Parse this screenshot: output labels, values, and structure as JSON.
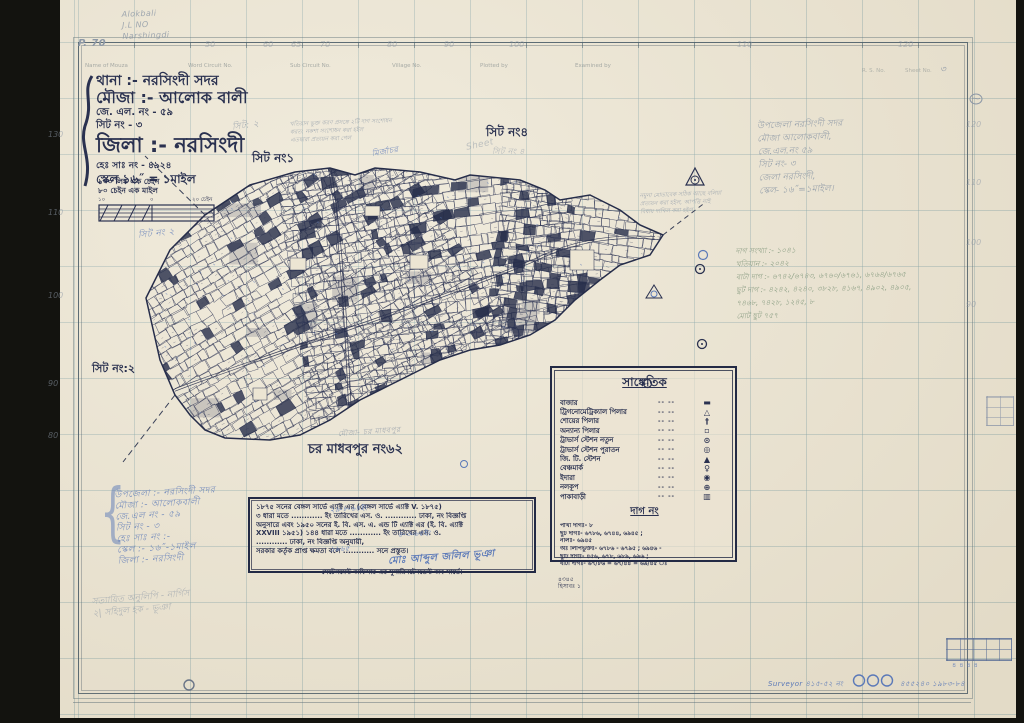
{
  "colors": {
    "ink": "#2a3150",
    "pencil": "#8d98a6",
    "blue": "#5b79b8",
    "paper": "#ece5d3"
  },
  "corner_notes": {
    "p_no": "P. 70",
    "lines": [
      "Alokbali",
      "J.L NO",
      "Narshingdi"
    ]
  },
  "margins": {
    "top_numbers": [
      "50",
      "60",
      "65",
      "70",
      "80",
      "90",
      "100",
      "110",
      "120"
    ],
    "left_numbers": [
      "130",
      "110",
      "100",
      "90",
      "80"
    ],
    "right_numbers": [
      "120",
      "110",
      "100",
      "90"
    ],
    "header_cells": [
      "Name of Mouza",
      "Word Circuit No.",
      "Sub Circuit No.",
      "Village No.",
      "Plotted by",
      "Examined by"
    ],
    "rs_label": "R. S. No.",
    "sheet_label": "Sheet No.",
    "sheet_value": "৩"
  },
  "title_block": {
    "lines": [
      "থানা :- নরসিংদী সদর",
      "মৌজা :- আলোক বালী",
      "জে. এল. নং - ৫৯",
      "সিট নং -  ৩",
      "জিলা :- নরসিংদী",
      "হেঃ সাঃ নং - ৪৯২৪",
      "স্কেল ১৬˝ = ১মাইল"
    ]
  },
  "scale_block": {
    "line1": "১০০ লিঙ্ক এক চেইন",
    "line2": "৮০ চেইন এক মাইল",
    "ticks": [
      "১০",
      "০",
      "২০ চেইন"
    ]
  },
  "sheet_labels": {
    "pencil2": "সিট নং ২",
    "pencil2b": "সিট: ২",
    "ink1": "সিট নং১",
    "ink4": "সিট নং৪",
    "pencil4": "সিট নং ৪",
    "pencil4_en": "Sheet",
    "left2": "সিট নং:২",
    "blue_scrib": "মির্জাচর"
  },
  "map_labels": {
    "south": "চর মাধবপুর নং৬২",
    "south_pencil": "মৌজা- চর মাধবপুর"
  },
  "legend": {
    "title": "সাঙ্কেতিক",
    "dash": "--  --",
    "rows": [
      {
        "label": "বাজার",
        "glyph": "▬"
      },
      {
        "label": "ট্রিগনোমেট্রিক্যাল পিলার",
        "glyph": "△"
      },
      {
        "label": "শোয়ের পিলার",
        "glyph": "†"
      },
      {
        "label": "অন্যান্য পিলার",
        "glyph": "▫"
      },
      {
        "label": "ট্রাভার্স স্টেশন নতুন",
        "glyph": "⊙"
      },
      {
        "label": "ট্রাভার্স স্টেশন পুরাতন",
        "glyph": "◎"
      },
      {
        "label": "জি. টি. স্টেশন",
        "glyph": "▲"
      },
      {
        "label": "বেঞ্চমার্ক",
        "glyph": "♀"
      },
      {
        "label": "ইদারা",
        "glyph": "◉"
      },
      {
        "label": "নলকূপ",
        "glyph": "⊕"
      },
      {
        "label": "পাকাবাড়ী",
        "glyph": "▥"
      }
    ],
    "plot_title": "দাগ নং",
    "plot_rows": [
      "পাখা দাগঃ-  ৮",
      "ছুট দাগঃ-  ৬৭৮৬, ৬৭৪৪, ৬৯৪৫ ;",
      "নালঃ-  ৬৯৪৫",
      "অঃ লিপিভুক্তঃ-  ৬৭৮৬ - ৬৭৯৫ ; ৬৯৪৬ -",
      "ছুটি দাগঃ-  ৪৫৬, ৬৭৮, ৬৮৯, ৬৯৬ ;",
      "বাটা দাগঃ-  ৬৭/৮৬ = ৬৭/৪৪ = ৬৯/৪৫ ঃ"
    ],
    "below_note": "৪৩৪৫",
    "below_note2": "হিসাবঃ ১"
  },
  "note_box": {
    "lines": [
      "১৮৭৫ সনের বেঙ্গল সার্ভে এ্যাক্ট এর  (বেঙ্গল সার্ভে এ্যাক্ট  V. ১৮৭৫)",
      "৩ ধারা মতে ............ ইং তারিখের এস. ও. ............ ঢাকা, নং বিজ্ঞপ্তি",
      "অনুসারে এবং ১৯৫০ সনের ই. বি. এস. এ. এন্ড টি এ্যাক্ট এর (ই. বি. এ্যাক্ট",
      "XXVIII ১৯৫১) ১৪৪ ধারা মতে ............ ইং তারিখের এস. ও.",
      "............ ঢাকা, নং বিজ্ঞপ্তি অনুযায়ী,",
      "সরকার কর্তৃক প্রাপ্ত ক্ষমতা বলে ............ সনে প্রস্তুত।"
    ],
    "blue_fills": [
      "২৯-৮-৬৪ইং",
      "৪-৩-৬৫ইং",
      "১৯৬৫"
    ],
    "signature": "মোঃ আব্দুল জলিল ভূঞা",
    "footer": "সেটেলমেন্ট অফিসার এর সুপারিনটেনডেন্ট অব সার্ভে।"
  },
  "pencil_blocks": {
    "top_right": [
      "উপজেলা নরসিংদী সদর",
      "মৌজা আলোকবালী,",
      "জে.এল.নং  ৫৯",
      "সিট নং-  ৩",
      "জেলা নরসিংদী,",
      "স্কেল- ১৬˝=১মাইল।"
    ],
    "mid_right": [
      "দাগ সংখ্যা :-  ১০৪১",
      "খতিয়ান :-  ২০৪২",
      "বাটা দাগ :- ৬৭৪২/৬৭৪৩, ৬৭৬০/৬৭৬১, ৬৭৬৪/৬৭৬৫",
      "ছুট দাগ :- ৪২৪২, ৪২৪০, ৩৮২৮, ৪১৬৭, ৪৯০২, ৪৯০৫,",
      "৭৪৬৮, ৭৪২৮, ১২৪৫, ৮",
      "মোট ছুট  ৭৫৭"
    ],
    "bottom_left": [
      "উপজেলা :- নরসিংদী সদর",
      "মৌজা :- আলোকবালী",
      "জে.এল নং - ৫৯",
      "সিট নং -  ৩",
      "হেঃ সাঃ নং :-",
      "স্কেল :- ১৬˝-১মাইল",
      "জিলা :- নরসিংদী"
    ],
    "bottom_left2": [
      "সত্যায়িত অনুলিপি - নার্গিস",
      "২| সহিদুল হক - ভূঞা"
    ],
    "para1": [
      "খতিয়ান ভুক্ত করণ প্রসঙ্গে ২টি দাগ সংশোধন",
      "করত: নকশা সংশোধন করা হইল",
      "এতদ্বারা প্রত্যয়ন করা গেল"
    ],
    "para2": [
      "নমুনা মোতাবেক সঠিক আছে বলিয়া",
      "প্রত্যয়ন করা হইল, আপত্তি নাই",
      "বিধায় দাখিল করা হইল"
    ]
  },
  "bottom_notes": {
    "surveyor": "Surveyor  ৪১৫-৫২ নং",
    "year": "৪৫৫২৪০  ১৯৮৩-৮৪",
    "mini_digits": "৪৪৪৪"
  }
}
